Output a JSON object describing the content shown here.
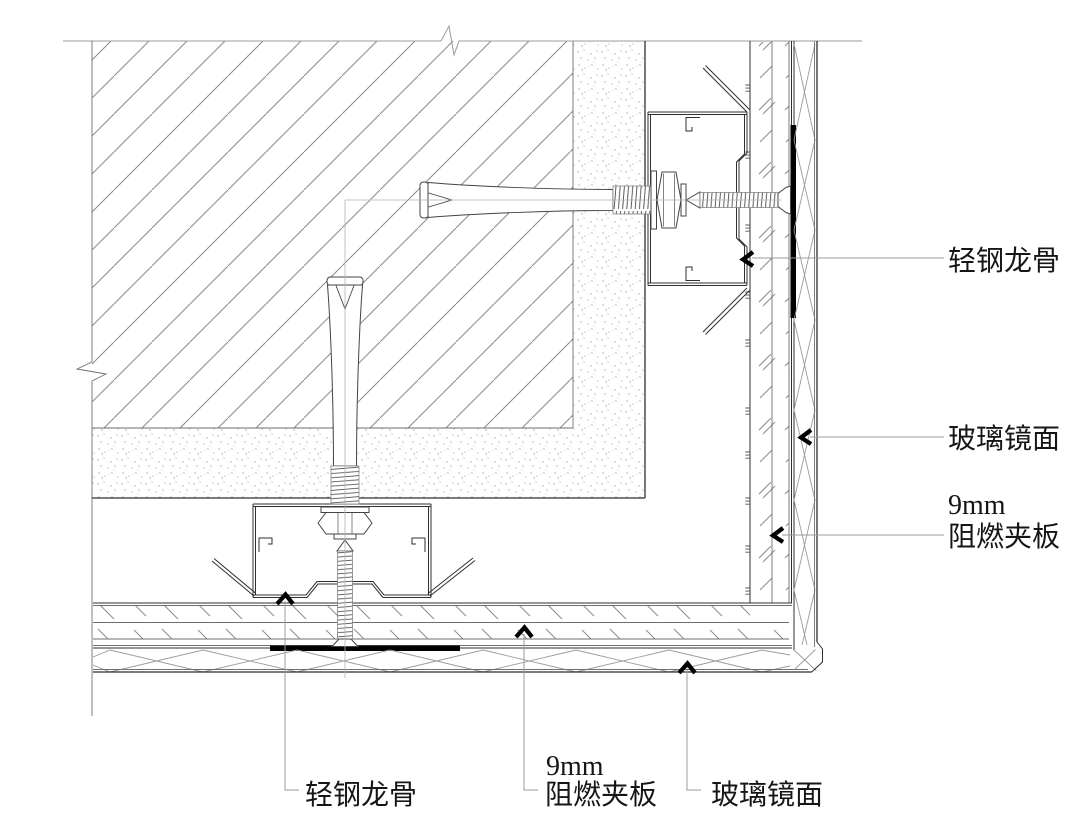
{
  "drawing": {
    "labels": {
      "right_keel": "轻钢龙骨",
      "right_mirror": "玻璃镜面",
      "right_board_size": "9mm",
      "right_board_name": "阻燃夹板",
      "bottom_keel": "轻钢龙骨",
      "bottom_board_size": "9mm",
      "bottom_board_name": "阻燃夹板",
      "bottom_mirror": "玻璃镜面"
    },
    "colors": {
      "background": "#ffffff",
      "line_dark": "#2f2f2f",
      "line_light": "#9b9b9b",
      "hatch": "#8a8a8a",
      "adhesive_pad": "#000000",
      "text": "#161616"
    }
  }
}
